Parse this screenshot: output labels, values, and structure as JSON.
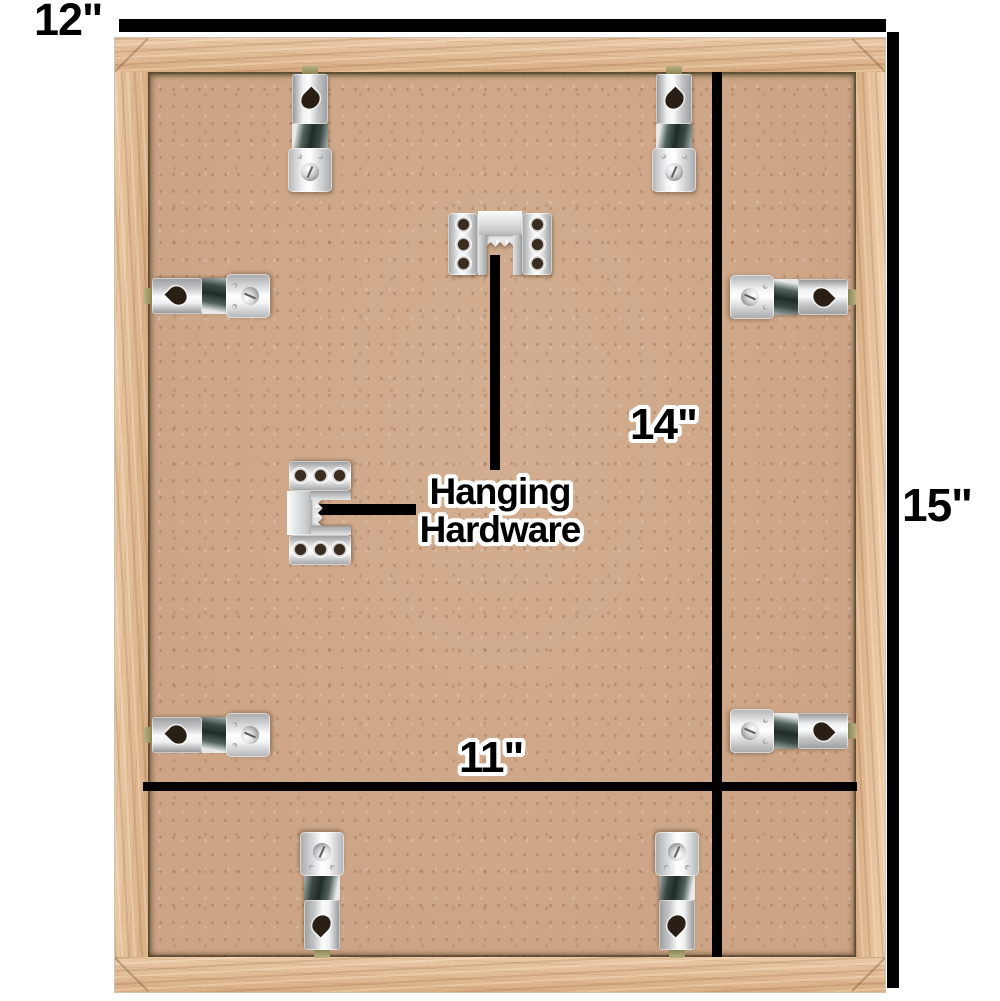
{
  "figure": {
    "type": "product-dimension-diagram",
    "subject": "Back view of a natural oak wood picture frame with MDF backing board, retainer clips and sawtooth hanging hardware"
  },
  "dimensions": {
    "outer_width": "12\"",
    "outer_height": "15\"",
    "inner_height": "14\"",
    "inner_width": "11\""
  },
  "labels": {
    "hardware_line1": "Hanging",
    "hardware_line2": "Hardware"
  },
  "hardware": {
    "retainer_clip_count": 8,
    "sawtooth_hanger_count": 2
  },
  "colors": {
    "background": "#ffffff",
    "frame_wood": "#dfb890",
    "backing_board": "#cda586",
    "dimension_line": "#000000",
    "metal_hardware": "#d8dadb"
  }
}
